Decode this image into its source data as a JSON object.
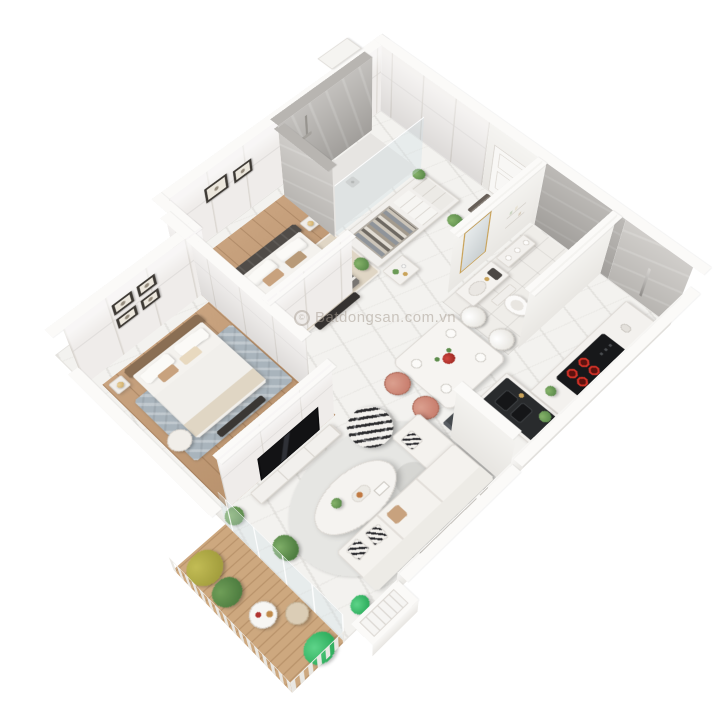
{
  "watermark": {
    "symbol": "©",
    "text": "Batdongsan.com.vn"
  },
  "palette": {
    "bg": "#ffffff",
    "marble": "#f3f2ef",
    "marble-vein": "#dcd9d4",
    "wood": "#c49b74",
    "wood-line": "#a0744d",
    "wood-balcony": "#cda87f",
    "wall-face": "#efecea",
    "wall-line": "#d8d4ce",
    "wall-top": "#fbfaf8",
    "gray-wall": "#b3b0ac",
    "gray-wall-light": "#c7c4c0",
    "glass": "rgba(205,223,229,0.30)",
    "rug-beige": "#e0d6c5",
    "rug-blue": "#a9b4bc",
    "rug-gray": "#e6e6e3",
    "bed-dark": "#504c48",
    "blanket": "#787572",
    "tan": "#c8a27e",
    "fabric-white": "#f4f2ee",
    "steel": "#494d51",
    "appliance-black": "#17181a",
    "burner-red": "#d23127",
    "coral": "#c98070",
    "gold": "#c9a35a",
    "green": "#5d8c4c",
    "green-bright": "#2fae5e",
    "yellow-green": "#a49f3e",
    "headboard2": "#8a6e53"
  },
  "scene": {
    "type": "3d-isometric-floorplan",
    "description": "3D cut-away floor plan of a two-bedroom apartment on a white background",
    "rooms": [
      {
        "name": "master-bedroom",
        "furniture": [
          "double-bed",
          "tufted-headboard",
          "striped-blanket",
          "pillows",
          "nightstands",
          "table-lamps",
          "two-wall-frames",
          "foot-bench",
          "beige-rug",
          "potted-plant"
        ]
      },
      {
        "name": "walk-in-wardrobe",
        "furniture": [
          "open-closet-with-clothes",
          "folded-shelves",
          "drawers",
          "potted-plant"
        ]
      },
      {
        "name": "ensuite-shower",
        "furniture": [
          "gray-marble-walls",
          "glass-screen",
          "shower-head",
          "floor-drain"
        ]
      },
      {
        "name": "second-bedroom",
        "furniture": [
          "double-bed",
          "brown-headboard",
          "white-duvet",
          "nightstand",
          "table-lamp",
          "four-wall-frames",
          "round-pouf-chair",
          "wardrobe-with-clothes",
          "blue-rug",
          "foot-bench"
        ]
      },
      {
        "name": "entry-hall",
        "furniture": [
          "entrance-door",
          "doormat",
          "console-table",
          "potted-plant"
        ]
      },
      {
        "name": "bathroom",
        "furniture": [
          "vanity-with-basin",
          "gold-framed-mirror",
          "toilet",
          "towel-shelf",
          "chrome-towel-stand",
          "wall-shelves"
        ]
      },
      {
        "name": "kitchen",
        "furniture": [
          "french-door-refrigerator",
          "black-sink-countertop",
          "double-sink",
          "cooktop-with-red-burners",
          "kettle",
          "counter-plant"
        ]
      },
      {
        "name": "dining-area",
        "furniture": [
          "dining-table",
          "two-coral-chairs",
          "two-white-chairs",
          "red-flower-centerpiece",
          "place-settings"
        ]
      },
      {
        "name": "living-room",
        "furniture": [
          "white-sofa",
          "patterned-pillows",
          "oval-coffee-table",
          "patterned-bean-bag",
          "tv",
          "tv-console",
          "gray-rug",
          "plants"
        ]
      },
      {
        "name": "balcony",
        "furniture": [
          "slatted-railing",
          "yellow-green-plant",
          "green-plants",
          "bright-palm",
          "round-side-table",
          "pouf",
          "wood-deck"
        ]
      }
    ]
  }
}
